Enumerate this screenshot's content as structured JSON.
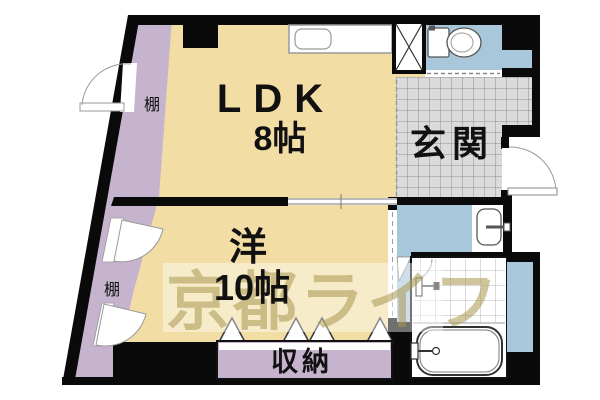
{
  "plan": {
    "title": "apartment-floor-plan",
    "rooms": {
      "ldk": {
        "label": "LDK",
        "size": "8帖"
      },
      "western": {
        "label": "洋",
        "size": "10帖"
      },
      "entrance": {
        "label": "玄関"
      },
      "storage": {
        "label": "収納"
      },
      "shelf_upper": {
        "label": "棚"
      },
      "shelf_lower": {
        "label": "棚"
      }
    },
    "fixtures": [
      "toilet",
      "kitchen-counter-sink",
      "pipe-space",
      "washbasin",
      "bathtub",
      "shower"
    ],
    "watermark": {
      "text": "京都ライフ"
    },
    "colors": {
      "wall": "#0a0a0a",
      "floor": "#f2dea4",
      "shelf_strip": "#c6b3ce",
      "storage_fill": "#c6b3ce",
      "water_area": "#a9c7db",
      "entrance_tile": "#dbdbdb",
      "tile_grid_line": "#8f8f8f",
      "watermark": "#aa9850"
    }
  }
}
